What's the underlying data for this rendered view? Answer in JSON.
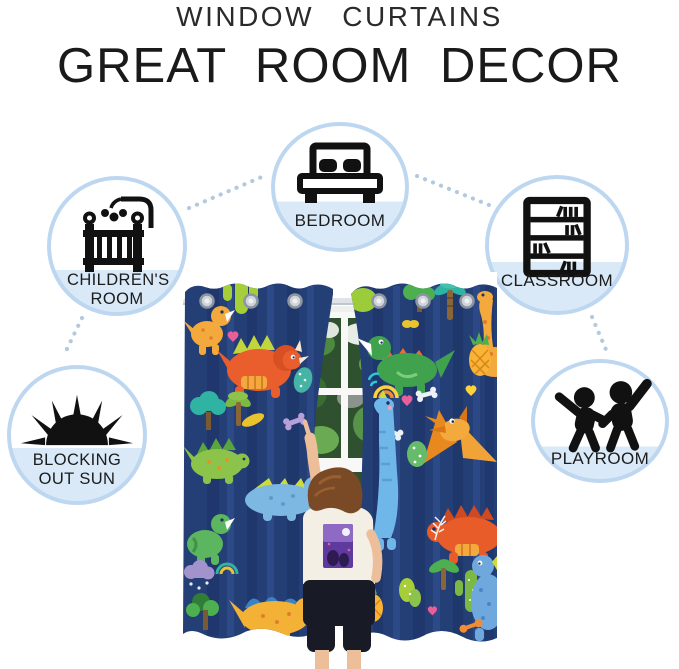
{
  "header": {
    "subtitle": "WINDOW CURTAINS",
    "title": "GREAT ROOM DECOR"
  },
  "features": [
    {
      "label": "BEDROOM",
      "icon": "bed-icon",
      "position": "top-center"
    },
    {
      "label": "CHILDREN'S ROOM",
      "icon": "crib-icon",
      "position": "upper-left"
    },
    {
      "label": "CLASSROOM",
      "icon": "bookshelf-icon",
      "position": "upper-right"
    },
    {
      "label": "BLOCKING OUT SUN",
      "icon": "sun-icon",
      "position": "lower-left"
    },
    {
      "label": "PLAYROOM",
      "icon": "children-playing-icon",
      "position": "lower-right"
    }
  ],
  "photo": {
    "alt": "Child reaching up between two navy blue dinosaur print curtain panels hanging from a silver rod in front of a white window with green plants outside"
  },
  "colors": {
    "circle_ring": "#bed7f0",
    "circle_band": "#d9e9f8",
    "connector_dots": "#b3c9de",
    "icon_black": "#111111",
    "label_text": "#1c1c1c",
    "curtain_navy": "#243e76"
  }
}
